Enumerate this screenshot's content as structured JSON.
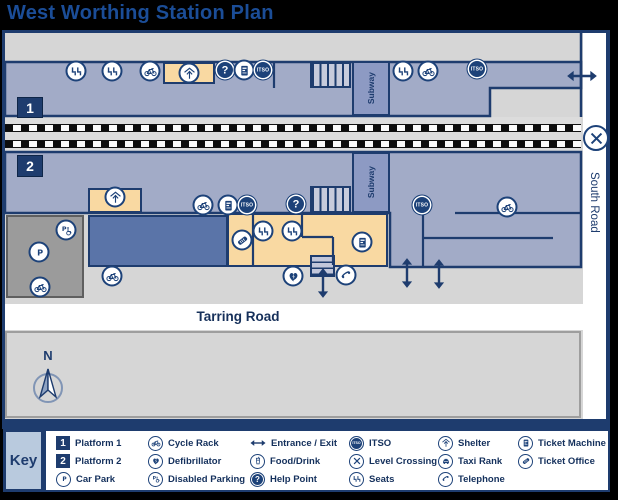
{
  "title": "West Worthing Station Plan",
  "colors": {
    "navy": "#1e3c6e",
    "icon_navy": "#1d4279",
    "platform_blue": "#a2abc7",
    "corridor_blue": "#8d9ac3",
    "shelter_tan": "#f9d9a2",
    "canopy_blue": "#5a74a8",
    "car_park_gray": "#9b9b9b",
    "map_gray": "#d6d6d6",
    "road_white": "#ffffff",
    "title_blue": "#1b4d97",
    "key_label_bg": "#b9cade"
  },
  "map": {
    "labels": {
      "subway_top": "Subway",
      "subway_bottom": "Subway",
      "south_road": "South Road",
      "tarring_road": "Tarring Road",
      "platform1": "1",
      "platform2": "2",
      "compass_north": "N"
    },
    "icon_text": {
      "itso": "ITSO",
      "help-point": "?"
    },
    "markers": [
      {
        "icon": "seats",
        "x": 76,
        "y": 71
      },
      {
        "icon": "seats",
        "x": 112,
        "y": 71
      },
      {
        "icon": "cycle-rack",
        "x": 150,
        "y": 71
      },
      {
        "icon": "shelter",
        "x": 189,
        "y": 73
      },
      {
        "icon": "help-point",
        "x": 225,
        "y": 70
      },
      {
        "icon": "ticket-machine",
        "x": 244,
        "y": 70
      },
      {
        "icon": "itso",
        "x": 263,
        "y": 70
      },
      {
        "icon": "seats",
        "x": 403,
        "y": 71
      },
      {
        "icon": "cycle-rack",
        "x": 428,
        "y": 71
      },
      {
        "icon": "itso",
        "x": 477,
        "y": 69
      },
      {
        "icon": "entrance-arrow-h",
        "x": 582,
        "y": 76
      },
      {
        "icon": "level-crossing",
        "x": 596,
        "y": 138
      },
      {
        "icon": "shelter",
        "x": 115,
        "y": 197
      },
      {
        "icon": "cycle-rack",
        "x": 203,
        "y": 205
      },
      {
        "icon": "ticket-machine",
        "x": 228,
        "y": 205
      },
      {
        "icon": "itso",
        "x": 247,
        "y": 205
      },
      {
        "icon": "help-point",
        "x": 296,
        "y": 204
      },
      {
        "icon": "itso",
        "x": 422,
        "y": 205
      },
      {
        "icon": "cycle-rack",
        "x": 507,
        "y": 207
      },
      {
        "icon": "ticket-office",
        "x": 242,
        "y": 240
      },
      {
        "icon": "seats",
        "x": 263,
        "y": 231
      },
      {
        "icon": "seats",
        "x": 292,
        "y": 231
      },
      {
        "icon": "ticket-machine",
        "x": 362,
        "y": 242
      },
      {
        "icon": "defibrillator",
        "x": 293,
        "y": 276
      },
      {
        "icon": "telephone",
        "x": 346,
        "y": 275
      },
      {
        "icon": "disabled-parking",
        "x": 66,
        "y": 230
      },
      {
        "icon": "car-park",
        "x": 39,
        "y": 252
      },
      {
        "icon": "cycle-rack",
        "x": 40,
        "y": 287
      },
      {
        "icon": "cycle-rack",
        "x": 112,
        "y": 276
      },
      {
        "icon": "entrance-arrow-v",
        "x": 323,
        "y": 283
      },
      {
        "icon": "entrance-arrow-v",
        "x": 407,
        "y": 273
      },
      {
        "icon": "entrance-arrow-v",
        "x": 439,
        "y": 274
      }
    ]
  },
  "key": {
    "title": "Key",
    "columns": [
      [
        {
          "icon": "platform-1",
          "label": "Platform 1"
        },
        {
          "icon": "platform-2",
          "label": "Platform 2"
        },
        {
          "icon": "car-park",
          "label": "Car Park"
        }
      ],
      [
        {
          "icon": "cycle-rack",
          "label": "Cycle Rack"
        },
        {
          "icon": "defibrillator",
          "label": "Defibrillator"
        },
        {
          "icon": "disabled-parking",
          "label": "Disabled Parking"
        }
      ],
      [
        {
          "icon": "entrance",
          "label": "Entrance / Exit"
        },
        {
          "icon": "food-drink",
          "label": "Food/Drink"
        },
        {
          "icon": "help-point",
          "label": "Help Point"
        }
      ],
      [
        {
          "icon": "itso",
          "label": "ITSO"
        },
        {
          "icon": "level-crossing",
          "label": "Level Crossing"
        },
        {
          "icon": "seats",
          "label": "Seats"
        }
      ],
      [
        {
          "icon": "shelter",
          "label": "Shelter"
        },
        {
          "icon": "taxi-rank",
          "label": "Taxi Rank"
        },
        {
          "icon": "telephone",
          "label": "Telephone"
        }
      ],
      [
        {
          "icon": "ticket-machine",
          "label": "Ticket Machine"
        },
        {
          "icon": "ticket-office",
          "label": "Ticket Office"
        }
      ]
    ],
    "platform_glyphs": {
      "platform-1": "1",
      "platform-2": "2"
    }
  }
}
